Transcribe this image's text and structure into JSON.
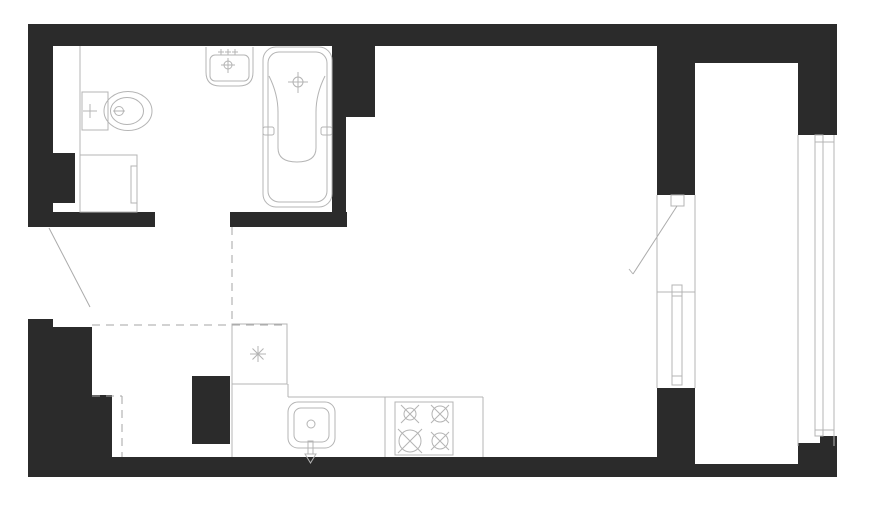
{
  "meta": {
    "type": "architectural-floor-plan",
    "subject": "studio-apartment-with-bathroom-kitchen-and-balcony",
    "canvas": {
      "width": 870,
      "height": 514
    },
    "background": "#ffffff"
  },
  "palette": {
    "wall_fill": "#2b2b2b",
    "fixture_line": "#b4b4b4",
    "hidden_line": "#a6a6a6",
    "door_leaf_line": "#ababab"
  },
  "plan": {
    "viewBox": "0 0 870 514",
    "layers": [
      {
        "name": "walls",
        "style": {
          "fill": "#2b2b2b",
          "stroke": "none"
        },
        "elements": [
          {
            "tag": "rect",
            "name": "top-wall",
            "attrs": {
              "x": 28,
              "y": 24,
              "width": 629,
              "height": 22
            }
          },
          {
            "tag": "rect",
            "name": "top-wall-balcony",
            "attrs": {
              "x": 657,
              "y": 24,
              "width": 180,
              "height": 39
            }
          },
          {
            "tag": "rect",
            "name": "left-wall-upper",
            "attrs": {
              "x": 28,
              "y": 24,
              "width": 25,
              "height": 202
            }
          },
          {
            "tag": "rect",
            "name": "left-wall-protrusion",
            "attrs": {
              "x": 53,
              "y": 153,
              "width": 22,
              "height": 50
            }
          },
          {
            "tag": "rect",
            "name": "bathroom-south-wall-left",
            "attrs": {
              "x": 28,
              "y": 212,
              "width": 127,
              "height": 15
            }
          },
          {
            "tag": "rect",
            "name": "bathroom-south-wall-right",
            "attrs": {
              "x": 230,
              "y": 212,
              "width": 117,
              "height": 15
            }
          },
          {
            "tag": "rect",
            "name": "bathroom-east-wall",
            "attrs": {
              "x": 332,
              "y": 46,
              "width": 14,
              "height": 181
            }
          },
          {
            "tag": "rect",
            "name": "bathroom-east-wall-pier",
            "attrs": {
              "x": 332,
              "y": 46,
              "width": 43,
              "height": 71
            }
          },
          {
            "tag": "rect",
            "name": "balcony-partition-upper",
            "attrs": {
              "x": 657,
              "y": 46,
              "width": 38,
              "height": 149
            }
          },
          {
            "tag": "rect",
            "name": "balcony-partition-lower",
            "attrs": {
              "x": 657,
              "y": 388,
              "width": 38,
              "height": 89
            }
          },
          {
            "tag": "rect",
            "name": "bottom-wall",
            "attrs": {
              "x": 28,
              "y": 457,
              "width": 667,
              "height": 20
            }
          },
          {
            "tag": "rect",
            "name": "balcony-bottom-wall",
            "attrs": {
              "x": 695,
              "y": 464,
              "width": 142,
              "height": 13
            }
          },
          {
            "tag": "rect",
            "name": "balcony-right-wall-top",
            "attrs": {
              "x": 798,
              "y": 24,
              "width": 39,
              "height": 111
            }
          },
          {
            "tag": "rect",
            "name": "balcony-right-wall-bottom",
            "attrs": {
              "x": 798,
              "y": 443,
              "width": 39,
              "height": 34
            }
          },
          {
            "tag": "rect",
            "name": "balcony-right-wall-step",
            "attrs": {
              "x": 820,
              "y": 436,
              "width": 17,
              "height": 8
            }
          },
          {
            "tag": "rect",
            "name": "left-wall-lower",
            "attrs": {
              "x": 28,
              "y": 327,
              "width": 64,
              "height": 130
            }
          },
          {
            "tag": "rect",
            "name": "left-wall-lower-step",
            "attrs": {
              "x": 28,
              "y": 319,
              "width": 25,
              "height": 8
            }
          },
          {
            "tag": "rect",
            "name": "left-wall-lower-extension",
            "attrs": {
              "x": 92,
              "y": 395,
              "width": 20,
              "height": 62
            }
          },
          {
            "tag": "rect",
            "name": "kitchen-duct-column",
            "attrs": {
              "x": 192,
              "y": 376,
              "width": 38,
              "height": 68
            }
          }
        ]
      },
      {
        "name": "fixtures",
        "style": {
          "fill": "none",
          "stroke": "#b4b4b4",
          "stroke-width": "1"
        },
        "elements": [
          {
            "tag": "line",
            "name": "bathroom-partition-line",
            "attrs": {
              "x1": 80,
              "y1": 46,
              "x2": 80,
              "y2": 155
            }
          },
          {
            "tag": "rect",
            "name": "toilet-cistern",
            "attrs": {
              "x": 82,
              "y": 92,
              "width": 26,
              "height": 38
            }
          },
          {
            "tag": "path",
            "name": "toilet-valve-cross",
            "attrs": {
              "d": "M90,104 V118 M83,111 H97"
            }
          },
          {
            "tag": "ellipse",
            "name": "toilet-bowl-outer",
            "attrs": {
              "cx": 128,
              "cy": 111,
              "rx": 24,
              "ry": 19.5
            }
          },
          {
            "tag": "ellipse",
            "name": "toilet-bowl-inner",
            "attrs": {
              "cx": 127,
              "cy": 111,
              "rx": 16.5,
              "ry": 13.5
            }
          },
          {
            "tag": "circle",
            "name": "toilet-flush-circle",
            "attrs": {
              "cx": 119,
              "cy": 111,
              "r": 4.5
            }
          },
          {
            "tag": "line",
            "name": "toilet-flush-bar",
            "attrs": {
              "x1": 113,
              "y1": 111,
              "x2": 125,
              "y2": 111
            }
          },
          {
            "tag": "rect",
            "name": "washing-machine-body",
            "attrs": {
              "x": 80,
              "y": 155,
              "width": 57,
              "height": 57
            }
          },
          {
            "tag": "rect",
            "name": "washing-machine-door",
            "attrs": {
              "x": 131,
              "y": 166,
              "width": 6,
              "height": 37
            }
          },
          {
            "tag": "path",
            "name": "wash-basin-outer",
            "attrs": {
              "d": "M206,47 L206,72 Q206,86 220,86 L239,86 Q253,86 253,72 L253,47"
            }
          },
          {
            "tag": "rect",
            "name": "wash-basin-inner",
            "attrs": {
              "x": 210,
              "y": 55,
              "width": 39,
              "height": 26,
              "rx": 5
            }
          },
          {
            "tag": "path",
            "name": "wash-basin-supply-crosses",
            "attrs": {
              "d": "M221,49 V55 M218,52 H224 M228,49 V55 M225,52 H231 M235,49 V55 M232,52 H238"
            }
          },
          {
            "tag": "path",
            "name": "wash-basin-faucet-cross",
            "attrs": {
              "d": "M228,58 V73 M221,65 H235"
            }
          },
          {
            "tag": "circle",
            "name": "wash-basin-faucet-circle",
            "attrs": {
              "cx": 228,
              "cy": 65,
              "r": 4
            }
          },
          {
            "tag": "rect",
            "name": "bathtub-outer",
            "attrs": {
              "x": 263,
              "y": 47,
              "width": 69,
              "height": 160,
              "rx": 13
            }
          },
          {
            "tag": "rect",
            "name": "bathtub-inner",
            "attrs": {
              "x": 268,
              "y": 52,
              "width": 59,
              "height": 150,
              "rx": 11
            }
          },
          {
            "tag": "path",
            "name": "bathtub-basin",
            "attrs": {
              "d": "M269,76 Q278,94 278,112 L278,148 Q278,162 297,162 Q316,162 316,148 L316,112 Q316,94 325,76"
            }
          },
          {
            "tag": "path",
            "name": "bathtub-faucet-cross",
            "attrs": {
              "d": "M298,72 V93 M288,82 H308"
            }
          },
          {
            "tag": "circle",
            "name": "bathtub-faucet-circle",
            "attrs": {
              "cx": 298,
              "cy": 82,
              "r": 5
            }
          },
          {
            "tag": "rect",
            "name": "bathtub-grip-left",
            "attrs": {
              "x": 263,
              "y": 127,
              "width": 11,
              "height": 8,
              "rx": 2
            }
          },
          {
            "tag": "rect",
            "name": "bathtub-grip-right",
            "attrs": {
              "x": 321,
              "y": 127,
              "width": 11,
              "height": 8,
              "rx": 2
            }
          },
          {
            "tag": "line",
            "name": "entrance-door-leaf",
            "attrs": {
              "x1": 49,
              "y1": 228,
              "x2": 90,
              "y2": 307,
              "stroke": "#ababab"
            }
          },
          {
            "tag": "rect",
            "name": "balcony-door-frame",
            "attrs": {
              "x": 671,
              "y": 195,
              "width": 13,
              "height": 11
            }
          },
          {
            "tag": "line",
            "name": "balcony-door-leaf",
            "attrs": {
              "x1": 677,
              "y1": 206,
              "x2": 633,
              "y2": 274,
              "stroke": "#ababab"
            }
          },
          {
            "tag": "line",
            "name": "balcony-door-leaf-tick",
            "attrs": {
              "x1": 633,
              "y1": 274,
              "x2": 629,
              "y2": 269
            }
          },
          {
            "tag": "line",
            "name": "window-reveal-inner",
            "attrs": {
              "x1": 657,
              "y1": 195,
              "x2": 657,
              "y2": 388
            }
          },
          {
            "tag": "line",
            "name": "window-reveal-outer",
            "attrs": {
              "x1": 695,
              "y1": 195,
              "x2": 695,
              "y2": 388
            }
          },
          {
            "tag": "line",
            "name": "window-sill-line",
            "attrs": {
              "x1": 657,
              "y1": 292,
              "x2": 695,
              "y2": 292
            }
          },
          {
            "tag": "rect",
            "name": "window-frame",
            "attrs": {
              "x": 672,
              "y": 285,
              "width": 10,
              "height": 100
            }
          },
          {
            "tag": "line",
            "name": "window-frame-tick-top",
            "attrs": {
              "x1": 672,
              "y1": 296,
              "x2": 682,
              "y2": 296
            }
          },
          {
            "tag": "line",
            "name": "window-frame-tick-bottom",
            "attrs": {
              "x1": 672,
              "y1": 376,
              "x2": 682,
              "y2": 376
            }
          },
          {
            "tag": "line",
            "name": "balcony-glazing-inner-line",
            "attrs": {
              "x1": 798,
              "y1": 135,
              "x2": 798,
              "y2": 446
            }
          },
          {
            "tag": "line",
            "name": "balcony-glazing-outer-line",
            "attrs": {
              "x1": 834,
              "y1": 135,
              "x2": 834,
              "y2": 446
            }
          },
          {
            "tag": "rect",
            "name": "balcony-glazing-frame",
            "attrs": {
              "x": 815,
              "y": 135,
              "width": 8,
              "height": 301
            }
          },
          {
            "tag": "line",
            "name": "balcony-glazing-tick-top",
            "attrs": {
              "x1": 815,
              "y1": 142,
              "x2": 834,
              "y2": 142
            }
          },
          {
            "tag": "line",
            "name": "balcony-glazing-tick-bottom",
            "attrs": {
              "x1": 815,
              "y1": 430,
              "x2": 834,
              "y2": 430
            }
          },
          {
            "tag": "rect",
            "name": "kitchen-corner-unit",
            "attrs": {
              "x": 232,
              "y": 324,
              "width": 55,
              "height": 60
            }
          },
          {
            "tag": "path",
            "name": "kitchen-corner-unit-symbol",
            "attrs": {
              "d": "M258,346 V362 M250,354 H266 M252.5,348.5 L263.5,359.5 M263.5,348.5 L252.5,359.5"
            }
          },
          {
            "tag": "line",
            "name": "kitchen-cabinet-edge",
            "attrs": {
              "x1": 232,
              "y1": 384,
              "x2": 232,
              "y2": 457
            }
          },
          {
            "tag": "line",
            "name": "kitchen-counter-left-step",
            "attrs": {
              "x1": 288,
              "y1": 384,
              "x2": 288,
              "y2": 397
            }
          },
          {
            "tag": "line",
            "name": "kitchen-counter-front",
            "attrs": {
              "x1": 288,
              "y1": 397,
              "x2": 483,
              "y2": 397
            }
          },
          {
            "tag": "line",
            "name": "kitchen-counter-right-edge",
            "attrs": {
              "x1": 483,
              "y1": 397,
              "x2": 483,
              "y2": 457
            }
          },
          {
            "tag": "line",
            "name": "kitchen-counter-separator",
            "attrs": {
              "x1": 385,
              "y1": 397,
              "x2": 385,
              "y2": 457
            }
          },
          {
            "tag": "rect",
            "name": "stove-outline",
            "attrs": {
              "x": 395,
              "y": 402,
              "width": 58,
              "height": 53
            }
          },
          {
            "tag": "circle",
            "name": "stove-burner-tl",
            "attrs": {
              "cx": 410,
              "cy": 414,
              "r": 6
            }
          },
          {
            "tag": "path",
            "name": "stove-burner-tl-cross",
            "attrs": {
              "d": "M401,405 L419,423 M419,405 L401,423"
            }
          },
          {
            "tag": "circle",
            "name": "stove-burner-tr",
            "attrs": {
              "cx": 440,
              "cy": 414,
              "r": 8
            }
          },
          {
            "tag": "path",
            "name": "stove-burner-tr-cross",
            "attrs": {
              "d": "M431,405 L449,423 M449,405 L431,423"
            }
          },
          {
            "tag": "circle",
            "name": "stove-burner-bl",
            "attrs": {
              "cx": 410,
              "cy": 441,
              "r": 11
            }
          },
          {
            "tag": "path",
            "name": "stove-burner-bl-cross",
            "attrs": {
              "d": "M398,429 L422,453 M422,429 L398,453"
            }
          },
          {
            "tag": "circle",
            "name": "stove-burner-br",
            "attrs": {
              "cx": 440,
              "cy": 441,
              "r": 8
            }
          },
          {
            "tag": "path",
            "name": "stove-burner-br-cross",
            "attrs": {
              "d": "M431,432 L449,450 M449,432 L431,450"
            }
          },
          {
            "tag": "rect",
            "name": "kitchen-sink-outer",
            "attrs": {
              "x": 288,
              "y": 402,
              "width": 47,
              "height": 46,
              "rx": 10
            }
          },
          {
            "tag": "rect",
            "name": "kitchen-sink-inner",
            "attrs": {
              "x": 294,
              "y": 408,
              "width": 35,
              "height": 34,
              "rx": 7
            }
          },
          {
            "tag": "circle",
            "name": "kitchen-sink-drain",
            "attrs": {
              "cx": 311,
              "cy": 424,
              "r": 4
            }
          },
          {
            "tag": "rect",
            "name": "kitchen-sink-faucet-stem",
            "attrs": {
              "x": 308,
              "y": 441,
              "width": 5,
              "height": 13
            }
          },
          {
            "tag": "path",
            "name": "kitchen-sink-faucet-tip",
            "attrs": {
              "d": "M305,454 L316,454 L310.5,463 Z"
            }
          }
        ]
      },
      {
        "name": "hidden-lines",
        "style": {
          "fill": "none",
          "stroke": "#a6a6a6",
          "stroke-width": "1",
          "stroke-dasharray": "8 6"
        },
        "elements": [
          {
            "tag": "line",
            "name": "zone-boundary-dash-horizontal",
            "attrs": {
              "x1": 92,
              "y1": 325,
              "x2": 287,
              "y2": 325
            }
          },
          {
            "tag": "line",
            "name": "zone-boundary-dash-vertical",
            "attrs": {
              "x1": 232,
              "y1": 227,
              "x2": 232,
              "y2": 324
            }
          },
          {
            "tag": "line",
            "name": "wall-niche-dash-top",
            "attrs": {
              "x1": 92,
              "y1": 396,
              "x2": 122,
              "y2": 396
            }
          },
          {
            "tag": "line",
            "name": "wall-niche-dash-side",
            "attrs": {
              "x1": 122,
              "y1": 396,
              "x2": 122,
              "y2": 457
            }
          }
        ]
      }
    ]
  }
}
